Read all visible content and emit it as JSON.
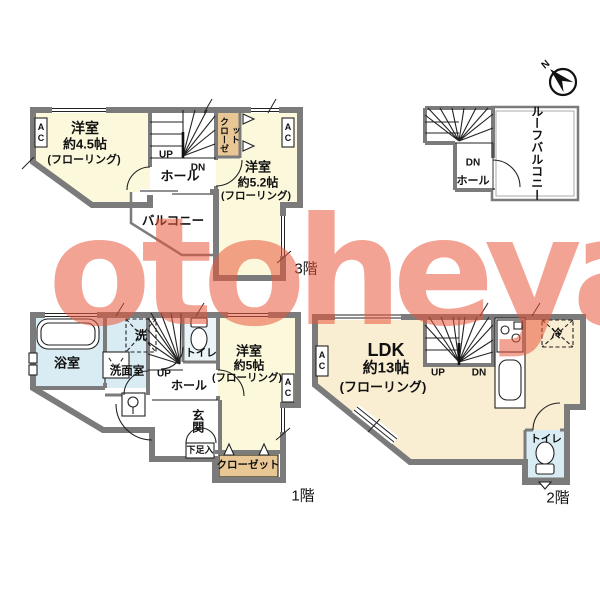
{
  "palette": {
    "wall": "#7b7b7b",
    "room": "#fcf8dc",
    "room2": "#f9edd2",
    "water": "#d9ecf4",
    "water2": "#eaf4f9",
    "closet": "#e8c795",
    "watermark": "rgba(234,88,58,0.55)"
  },
  "watermark": "otoheya",
  "compass": {
    "north": "N"
  },
  "floor3": {
    "label": "3階",
    "room1": {
      "name": "洋室",
      "size": "約4.5帖",
      "note": "(フローリング)"
    },
    "room2": {
      "name": "洋室",
      "size": "約5.2帖",
      "note": "(フローリング)"
    },
    "closet": "クローゼット",
    "hall": "ホール",
    "balcony": "バルコニー",
    "up": "UP",
    "dn": "DN",
    "ac": "AC"
  },
  "roof": {
    "balcony": "ルーフバルコニー",
    "hall": "ホール",
    "dn": "DN"
  },
  "floor1": {
    "label": "1階",
    "bath": "浴室",
    "washer": "洗",
    "washroom": "洗面室",
    "toilet": "トイレ",
    "room": {
      "name": "洋室",
      "size": "約5帖",
      "note": "(フローリング)"
    },
    "entrance": "玄関",
    "shoe_box": "下足入",
    "closet": "クローゼット",
    "hall": "ホール",
    "up": "UP",
    "ac": "AC"
  },
  "floor2": {
    "label": "2階",
    "ldk": {
      "name": "LDK",
      "size": "約13帖",
      "note": "(フローリング)"
    },
    "fridge": "冷",
    "toilet": "トイレ",
    "up": "UP",
    "dn": "DN",
    "ac": "AC"
  }
}
